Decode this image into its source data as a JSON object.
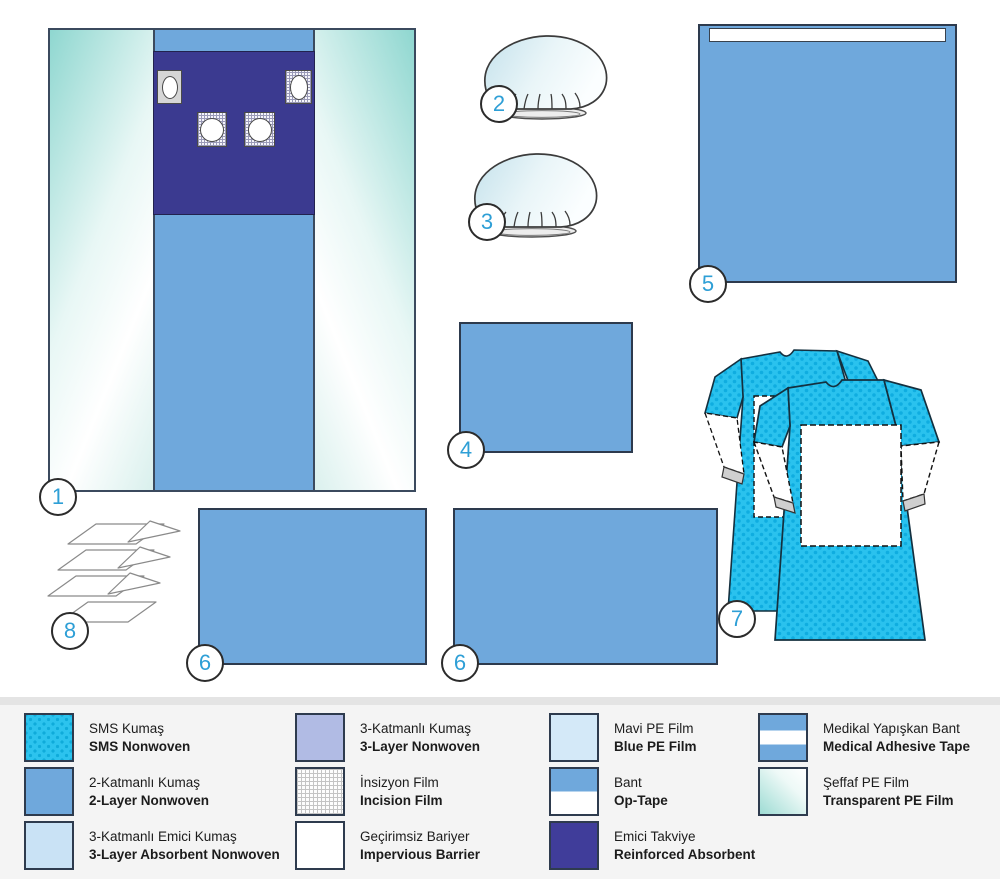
{
  "badges": [
    "1",
    "2",
    "3",
    "4",
    "5",
    "6",
    "6",
    "7",
    "8"
  ],
  "legend": {
    "columns": [
      {
        "items": [
          {
            "tr": "SMS Kumaş",
            "en": "SMS Nonwoven",
            "swatch": "sms"
          },
          {
            "tr": "2-Katmanlı Kumaş",
            "en": "2-Layer Nonwoven",
            "swatch": "blue"
          },
          {
            "tr": "3-Katmanlı Emici Kumaş",
            "en": "3-Layer Absorbent Nonwoven",
            "swatch": "lightblue"
          }
        ]
      },
      {
        "items": [
          {
            "tr": "3-Katmanlı Kumaş",
            "en": "3-Layer Nonwoven",
            "swatch": "lavender"
          },
          {
            "tr": "İnsizyon Film",
            "en": "Incision Film",
            "swatch": "grid"
          },
          {
            "tr": "Geçirimsiz Bariyer",
            "en": "Impervious Barrier",
            "swatch": "white"
          }
        ]
      },
      {
        "items": [
          {
            "tr": "Mavi PE Film",
            "en": "Blue PE Film",
            "swatch": "bluepe"
          },
          {
            "tr": "Bant",
            "en": "Op-Tape",
            "swatch": "optape"
          },
          {
            "tr": "Emici Takviye",
            "en": "Reinforced Absorbent",
            "swatch": "navy"
          }
        ]
      },
      {
        "items": [
          {
            "tr": "Medikal Yapışkan Bant",
            "en": "Medical Adhesive Tape",
            "swatch": "adhesive"
          },
          {
            "tr": "Şeffaf PE Film",
            "en": "Transparent PE Film",
            "swatch": "transparent"
          }
        ]
      }
    ]
  },
  "colors": {
    "sms_cyan": "#2cc3ee",
    "nonwoven_blue": "#6fa8dc",
    "absorbent_lightblue": "#c9e2f5",
    "three_layer_lavender": "#b1bbe4",
    "reinforced_navy": "#3b3a90",
    "transparent_teal": "#9edcd4",
    "badge_number_blue": "#2e9fd6"
  }
}
